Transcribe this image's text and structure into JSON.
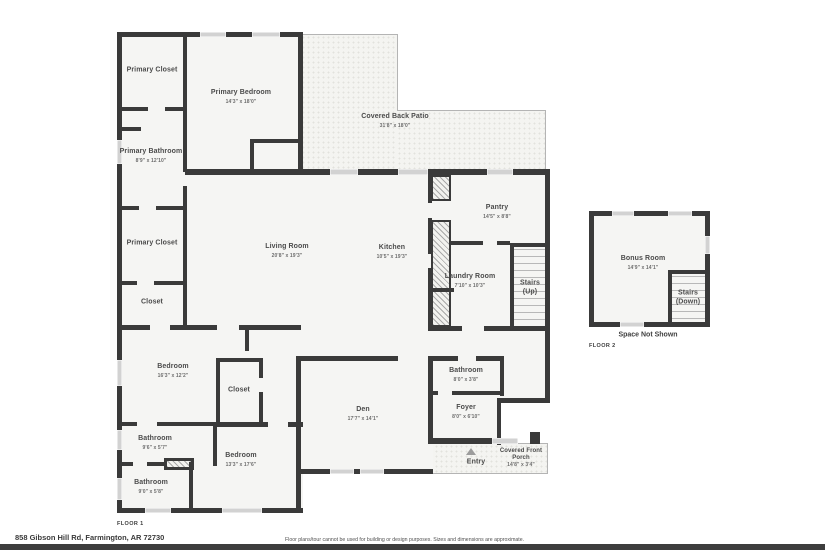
{
  "rooms": {
    "primary_closet_1": {
      "name": "Primary Closet"
    },
    "primary_bedroom": {
      "name": "Primary Bedroom",
      "dims": "14'3\" x 18'0\""
    },
    "covered_back_patio": {
      "name": "Covered Back Patio",
      "dims": "31'8\" x 18'0\""
    },
    "primary_bathroom": {
      "name": "Primary Bathroom",
      "dims": "8'9\" x 12'10\""
    },
    "primary_closet_2": {
      "name": "Primary Closet"
    },
    "closet_1": {
      "name": "Closet"
    },
    "living_room": {
      "name": "Living Room",
      "dims": "20'8\" x 19'3\""
    },
    "kitchen": {
      "name": "Kitchen",
      "dims": "10'5\" x 19'3\""
    },
    "pantry": {
      "name": "Pantry",
      "dims": "14'5\" x 8'8\""
    },
    "laundry_room": {
      "name": "Laundry Room",
      "dims": "7'10\" x 10'3\""
    },
    "stairs_up": {
      "name": "Stairs",
      "sub": "(Up)"
    },
    "bedroom_1": {
      "name": "Bedroom",
      "dims": "16'3\" x 12'2\""
    },
    "closet_2": {
      "name": "Closet"
    },
    "bathroom_1": {
      "name": "Bathroom",
      "dims": "9'6\" x 5'7\""
    },
    "bathroom_2": {
      "name": "Bathroom",
      "dims": "9'0\" x 5'8\""
    },
    "bedroom_2": {
      "name": "Bedroom",
      "dims": "13'3\" x 17'6\""
    },
    "den": {
      "name": "Den",
      "dims": "17'7\" x 14'1\""
    },
    "bathroom_3": {
      "name": "Bathroom",
      "dims": "8'0\" x 3'8\""
    },
    "foyer": {
      "name": "Foyer",
      "dims": "8'0\" x 6'10\""
    },
    "entry": {
      "name": "Entry"
    },
    "covered_front_porch": {
      "name": "Covered Front Porch",
      "dims": "14'8\" x 3'4\""
    },
    "bonus_room": {
      "name": "Bonus Room",
      "dims": "14'9\" x 14'1\""
    },
    "stairs_down": {
      "name": "Stairs",
      "sub": "(Down)"
    },
    "space_not_shown": {
      "name": "Space Not Shown"
    }
  },
  "floor_labels": {
    "floor_1": "FLOOR 1",
    "floor_2": "FLOOR 2"
  },
  "footer": {
    "address": "858 Gibson Hill Rd, Farmington, AR 72730",
    "disclaimer": "Floor plans/tour cannot be used for building or design purposes. Sizes and dimensions are approximate."
  },
  "colors": {
    "wall": "#3a3a3a",
    "room_fill": "#f5f5f3",
    "patio_fill": "#f4f4f1",
    "footer_bar": "#3d3d3d"
  }
}
